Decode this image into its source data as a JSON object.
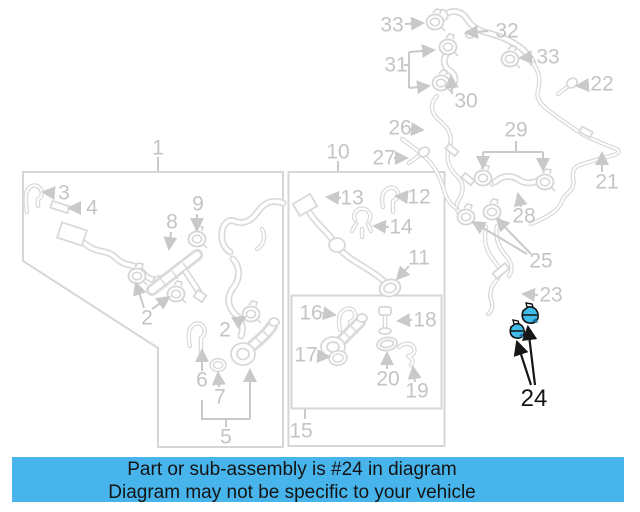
{
  "title": "Parts diagram with highlighted part",
  "banner": {
    "line1": "Part or sub-assembly is #24 in diagram",
    "line2": "Diagram may not be specific to your vehicle"
  },
  "highlighted_part": {
    "number": "24",
    "clamp_count": 2
  },
  "colors": {
    "banner_bg": "#47b5ec",
    "highlight_blue": "#41bce9",
    "highlight_shadow": "#1b6f9f",
    "label_gray": "#c4c4c4",
    "art_gray": "#dadada",
    "text_black": "#141414",
    "background": "#ffffff"
  },
  "labels": [
    {
      "key": "1",
      "n": "1",
      "x": 158,
      "y": 148,
      "tone": "gray"
    },
    {
      "key": "3",
      "n": "3",
      "x": 64,
      "y": 193,
      "tone": "gray"
    },
    {
      "key": "4",
      "n": "4",
      "x": 92,
      "y": 208,
      "tone": "gray"
    },
    {
      "key": "8",
      "n": "8",
      "x": 172,
      "y": 222,
      "tone": "gray"
    },
    {
      "key": "9",
      "n": "9",
      "x": 198,
      "y": 204,
      "tone": "gray"
    },
    {
      "key": "2-a",
      "n": "2",
      "x": 147,
      "y": 318,
      "tone": "gray"
    },
    {
      "key": "2-b",
      "n": "2",
      "x": 225,
      "y": 330,
      "tone": "gray"
    },
    {
      "key": "6",
      "n": "6",
      "x": 202,
      "y": 380,
      "tone": "gray"
    },
    {
      "key": "7",
      "n": "7",
      "x": 220,
      "y": 397,
      "tone": "gray"
    },
    {
      "key": "5",
      "n": "5",
      "x": 226,
      "y": 437,
      "tone": "gray"
    },
    {
      "key": "10",
      "n": "10",
      "x": 338,
      "y": 152,
      "tone": "gray"
    },
    {
      "key": "13",
      "n": "13",
      "x": 352,
      "y": 198,
      "tone": "gray"
    },
    {
      "key": "12",
      "n": "12",
      "x": 419,
      "y": 197,
      "tone": "gray"
    },
    {
      "key": "14",
      "n": "14",
      "x": 401,
      "y": 227,
      "tone": "gray"
    },
    {
      "key": "11",
      "n": "11",
      "x": 419,
      "y": 258,
      "tone": "gray"
    },
    {
      "key": "16",
      "n": "16",
      "x": 311,
      "y": 313,
      "tone": "gray"
    },
    {
      "key": "18",
      "n": "18",
      "x": 425,
      "y": 320,
      "tone": "gray"
    },
    {
      "key": "17",
      "n": "17",
      "x": 306,
      "y": 355,
      "tone": "gray"
    },
    {
      "key": "20",
      "n": "20",
      "x": 388,
      "y": 379,
      "tone": "gray"
    },
    {
      "key": "19",
      "n": "19",
      "x": 417,
      "y": 391,
      "tone": "gray"
    },
    {
      "key": "15",
      "n": "15",
      "x": 301,
      "y": 431,
      "tone": "gray"
    },
    {
      "key": "33-a",
      "n": "33",
      "x": 392,
      "y": 25,
      "tone": "gray"
    },
    {
      "key": "32",
      "n": "32",
      "x": 507,
      "y": 31,
      "tone": "gray"
    },
    {
      "key": "31",
      "n": "31",
      "x": 396,
      "y": 65,
      "tone": "gray"
    },
    {
      "key": "33-b",
      "n": "33",
      "x": 548,
      "y": 57,
      "tone": "gray"
    },
    {
      "key": "22",
      "n": "22",
      "x": 602,
      "y": 84,
      "tone": "gray"
    },
    {
      "key": "30",
      "n": "30",
      "x": 466,
      "y": 101,
      "tone": "gray"
    },
    {
      "key": "26",
      "n": "26",
      "x": 400,
      "y": 128,
      "tone": "gray"
    },
    {
      "key": "27",
      "n": "27",
      "x": 384,
      "y": 158,
      "tone": "gray"
    },
    {
      "key": "29",
      "n": "29",
      "x": 516,
      "y": 130,
      "tone": "gray"
    },
    {
      "key": "28",
      "n": "28",
      "x": 524,
      "y": 216,
      "tone": "gray"
    },
    {
      "key": "21",
      "n": "21",
      "x": 607,
      "y": 182,
      "tone": "gray"
    },
    {
      "key": "25",
      "n": "25",
      "x": 541,
      "y": 261,
      "tone": "gray"
    },
    {
      "key": "23",
      "n": "23",
      "x": 551,
      "y": 295,
      "tone": "gray"
    },
    {
      "key": "24",
      "n": "24",
      "x": 534,
      "y": 399,
      "tone": "black"
    }
  ]
}
